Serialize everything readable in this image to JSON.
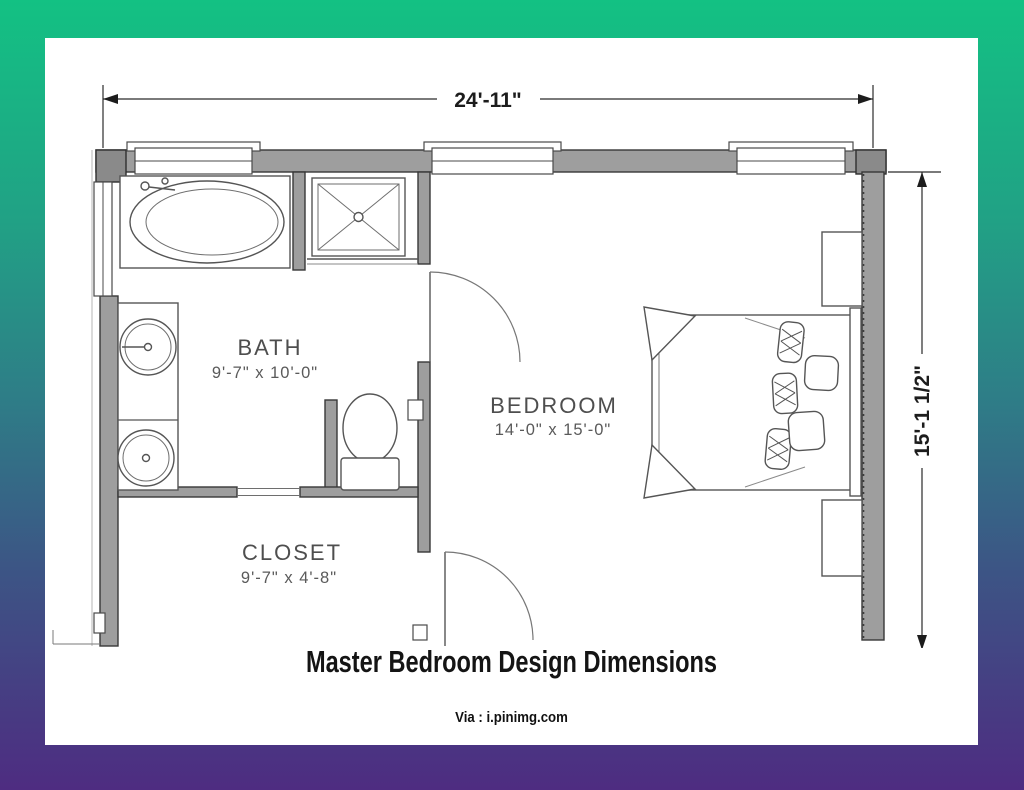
{
  "figure": {
    "title": "Master Bedroom Design Dimensions",
    "credit": "Via : i.pinimg.com"
  },
  "plan": {
    "overall_width": "24'-11\"",
    "overall_height": "15'-1 1/2\"",
    "rooms": [
      {
        "name": "BATH",
        "size": "9'-7\" x 10'-0\""
      },
      {
        "name": "BEDROOM",
        "size": "14'-0\" x 15'-0\""
      },
      {
        "name": "CLOSET",
        "size": "9'-7\" x 4'-8\""
      }
    ]
  },
  "colors": {
    "gradient_top": "#13c183",
    "gradient_middle": "#2e7e87",
    "gradient_bottom": "#4e2c81",
    "paper": "#ffffff",
    "wall_fill": "#9e9e9e",
    "line": "#383838",
    "label_text": "#4e4e4e",
    "dimension_text": "#1c1c1c"
  }
}
